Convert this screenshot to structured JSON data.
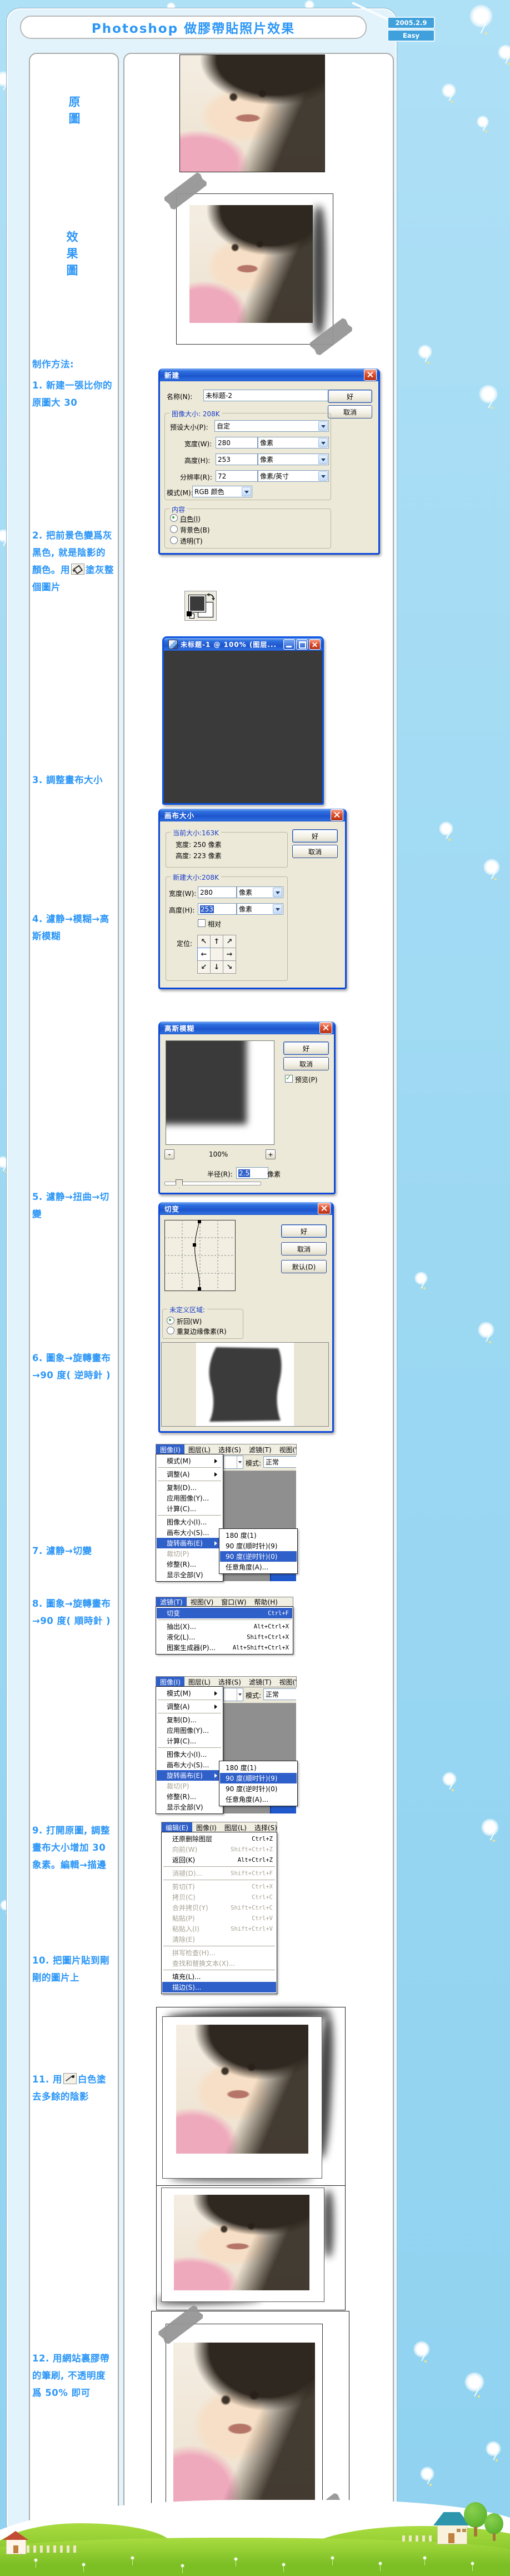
{
  "page": {
    "title": "Photoshop 做膠帶貼照片效果",
    "date": "2005.2.9",
    "level": "Easy"
  },
  "sidebar": {
    "label_original": "原圖",
    "label_effect": "效果圖",
    "making_method": "制作方法:",
    "step1": "1. 新建一張比你的原圖大 30",
    "step2_before": "2. 把前景色變爲灰黑色, 就是陰影的顏色。用",
    "step2_after": "塗灰整個圖片",
    "step3": "3. 調整畫布大小",
    "step4": "4. 濾静→模糊→高斯模糊",
    "step5": "5. 濾静→扭曲→切變",
    "step6": "6. 圖象→旋轉畫布→90 度( 逆時針 )",
    "step7": "7. 濾静→切變",
    "step8": "8. 圖象→旋轉畫布→90 度( 順時針 )",
    "step9": "9. 打開原圖, 調整畫布大小增加 30 象素。編輯→描邊",
    "step10": "10. 把圖片貼到剛剛的圖片上",
    "step11_before": "11. 用",
    "step11_after": "白色塗去多餘的陰影",
    "step12": "12. 用網站裏膠帶的筆刷, 不透明度爲 50% 即可"
  },
  "new_dialog": {
    "title": "新建",
    "ok": "好",
    "cancel": "取消",
    "name_label": "名称(N):",
    "name_value": "未标题-2",
    "image_size_group": "图像大小: 208K",
    "preset_label": "预设大小(P):",
    "preset_value": "自定",
    "width_label": "宽度(W):",
    "width_value": "280",
    "height_label": "高度(H):",
    "height_value": "253",
    "res_label": "分辨率(R):",
    "res_value": "72",
    "unit_px": "像素",
    "unit_ppi": "像素/英寸",
    "mode_label": "模式(M):",
    "mode_value": "RGB 颜色",
    "content_group": "内容",
    "radio_white": "白色(I)",
    "radio_bg": "背景色(B)",
    "radio_trans": "透明(T)"
  },
  "doc_window": {
    "title": "未标题-1 @ 100% (图层..."
  },
  "canvas_dialog": {
    "title": "画布大小",
    "ok": "好",
    "cancel": "取消",
    "current_group": "当前大小:163K",
    "cur_width": "宽度: 250 像素",
    "cur_height": "高度: 223 像素",
    "new_group": "新建大小:208K",
    "width_label": "宽度(W):",
    "width_value": "280",
    "height_label": "高度(H):",
    "height_value": "253",
    "unit_px": "像素",
    "relative_label": "相对",
    "anchor_label": "定位:",
    "anchor_arrows": [
      "↖",
      "↑",
      "↗",
      "←",
      "",
      "→",
      "↙",
      "↓",
      "↘"
    ]
  },
  "gaussian_dialog": {
    "title": "高斯模糊",
    "ok": "好",
    "cancel": "取消",
    "preview_label": "预览(P)",
    "zoom": "100%",
    "minus": "-",
    "plus": "+",
    "radius_label": "半径(R):",
    "radius_value": "2.5",
    "unit_px": "像素"
  },
  "shear_dialog": {
    "title": "切变",
    "ok": "好",
    "cancel": "取消",
    "default": "默认(D)",
    "undefined_group": "未定义区域:",
    "wrap": "折回(W)",
    "repeat": "重复边缘像素(R)"
  },
  "image_menu": {
    "menubar": [
      {
        "label": "图像(I)",
        "active": true
      },
      {
        "label": "图层(L)"
      },
      {
        "label": "选择(S)"
      },
      {
        "label": "滤镜(T)"
      },
      {
        "label": "视图(V"
      }
    ],
    "items": [
      {
        "label": "模式(M)",
        "arrow": true,
        "sep": true
      },
      {
        "label": "调整(A)",
        "arrow": true,
        "sep": true
      },
      {
        "label": "复制(D)..."
      },
      {
        "label": "应用图像(Y)..."
      },
      {
        "label": "计算(C)...",
        "sep": true
      },
      {
        "label": "图像大小(I)..."
      },
      {
        "label": "画布大小(S)..."
      },
      {
        "label": "旋转画布(E)",
        "arrow": true,
        "highlight": true
      },
      {
        "label": "裁切(P)",
        "disabled": true
      },
      {
        "label": "修整(R)..."
      },
      {
        "label": "显示全部(V)"
      }
    ],
    "submenu_ccw": [
      {
        "label": "180 度(1)"
      },
      {
        "label": "90 度(顺时针)(9)"
      },
      {
        "label": "90 度(逆时针)(0)",
        "highlight": true
      },
      {
        "label": "任意角度(A)..."
      }
    ],
    "submenu_cw": [
      {
        "label": "180 度(1)"
      },
      {
        "label": "90 度(顺时针)(9)",
        "highlight": true
      },
      {
        "label": "90 度(逆时针)(0)"
      },
      {
        "label": "任意角度(A)..."
      }
    ],
    "mode_label": "模式:",
    "mode_value": "正常"
  },
  "filter_menu": {
    "menubar": [
      {
        "label": "滤镜(T)",
        "active": true
      },
      {
        "label": "视图(V)"
      },
      {
        "label": "窗口(W)"
      },
      {
        "label": "帮助(H)"
      }
    ],
    "items": [
      {
        "label": "切变",
        "shortcut": "Ctrl+F",
        "highlight": true,
        "sep": true
      },
      {
        "label": "抽出(X)...",
        "shortcut": "Alt+Ctrl+X"
      },
      {
        "label": "液化(L)...",
        "shortcut": "Shift+Ctrl+X"
      },
      {
        "label": "图案生成器(P)...",
        "shortcut": "Alt+Shift+Ctrl+X"
      }
    ]
  },
  "edit_menu": {
    "menubar": [
      {
        "label": "编辑(E)",
        "active": true
      },
      {
        "label": "图像(I)"
      },
      {
        "label": "图层(L)"
      },
      {
        "label": "选择(S)"
      }
    ],
    "items": [
      {
        "label": "还原删除图层",
        "shortcut": "Ctrl+Z"
      },
      {
        "label": "向前(W)",
        "shortcut": "Shift+Ctrl+Z",
        "disabled": true
      },
      {
        "label": "返回(K)",
        "shortcut": "Alt+Ctrl+Z",
        "sep": true
      },
      {
        "label": "消褪(D)...",
        "shortcut": "Shift+Ctrl+F",
        "disabled": true,
        "sep": true
      },
      {
        "label": "剪切(T)",
        "shortcut": "Ctrl+X",
        "disabled": true
      },
      {
        "label": "拷贝(C)",
        "shortcut": "Ctrl+C",
        "disabled": true
      },
      {
        "label": "合并拷贝(Y)",
        "shortcut": "Shift+Ctrl+C",
        "disabled": true
      },
      {
        "label": "粘贴(P)",
        "shortcut": "Ctrl+V",
        "disabled": true
      },
      {
        "label": "粘贴入(I)",
        "shortcut": "Shift+Ctrl+V",
        "disabled": true
      },
      {
        "label": "清除(E)",
        "disabled": true,
        "sep": true
      },
      {
        "label": "拼写检查(H)...",
        "disabled": true
      },
      {
        "label": "查找和替换文本(X)...",
        "disabled": true,
        "sep": true
      },
      {
        "label": "填充(L)..."
      },
      {
        "label": "描边(S)...",
        "highlight": true
      }
    ]
  }
}
